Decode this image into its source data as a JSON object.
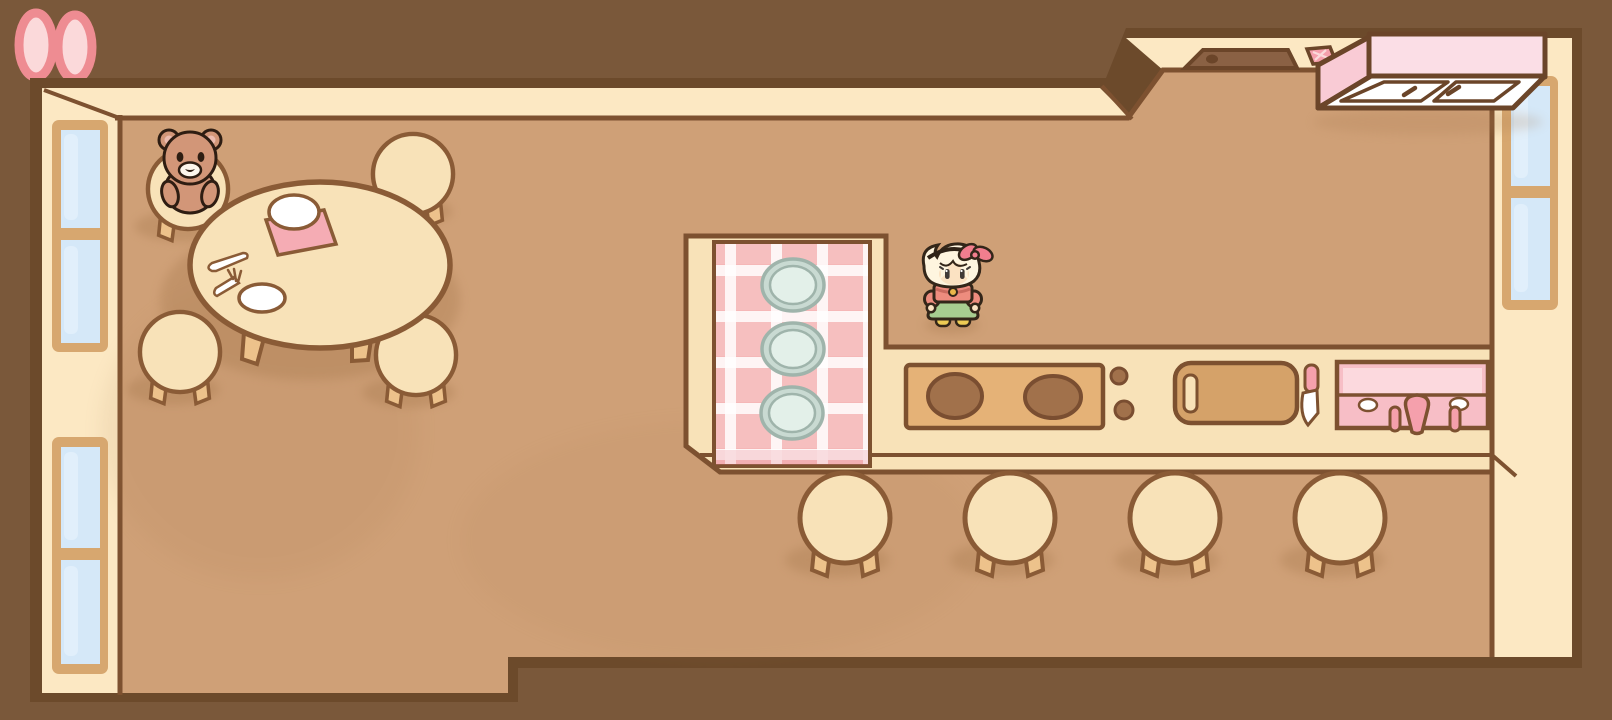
{
  "scene": {
    "title": "cozy-cafe-kitchen-room",
    "description": "Top-down cute cafe kitchen room with dining table, teddy bear, kitchen counter with stove and sink, bar stools, windows and a girl character standing by the counter"
  },
  "objects": {
    "decor": {
      "pink_ovals_top_left": 2
    },
    "dining_area": {
      "table": "round table",
      "stools": 4,
      "teddy_bear_seat": "top-left stool",
      "items_on_table": [
        "white plate",
        "pink napkin",
        "knife",
        "fork",
        "white plate"
      ]
    },
    "kitchen_counter": {
      "shape": "L",
      "tablecloth": "pink gingham",
      "plates_on_cloth": 3,
      "stove": {
        "burners": 2,
        "knobs": 2
      },
      "cutting_board": 1,
      "knife": 1,
      "sink": {
        "handles": 2,
        "faucet": 1,
        "soap_spots": 2
      }
    },
    "bar_stools": 4,
    "wall_counter": {
      "basin": 1,
      "drain": 1,
      "sponge": 1
    },
    "hanging_cabinet": {
      "doors": 2,
      "handles": 2
    },
    "windows": {
      "left_wall": 2,
      "right_wall": 1
    },
    "character": {
      "hair": "blonde with swoosh bang",
      "accessory": "pink bow headband",
      "top": "coral shirt with gold button",
      "skirt": "green",
      "shoes": "yellow"
    }
  },
  "palette": {
    "bg_outside": "#7A583A",
    "outline_dark": "#6C4A2B",
    "line_brown": "#7D5130",
    "furn_line": "#8A5B36",
    "wall_cream": "#FCE8C3",
    "floor_tan": "#CFA077",
    "shadow": "#A87A4F",
    "furniture_cream": "#F8E2B8",
    "furniture_leg": "#EDC28B",
    "cloth_pink": "#F5B7B7",
    "cloth_stripe": "#FFFFFF",
    "cloth_fold": "#E87F8C",
    "plate_rim": "#9FB4AB",
    "plate_outer": "#C9DAD2",
    "plate_inner": "#E3F0E9",
    "white": "#FFFFFF",
    "napkin_pink": "#F5ACB4",
    "stove_tan": "#E5B277",
    "burner_brown": "#A1714B",
    "burner_line": "#7A4E31",
    "board_tan": "#D5A269",
    "sink_pink": "#F7BEC6",
    "sink_light": "#FCD9DE",
    "sink_accent": "#F5A0AC",
    "cabinet_top": "#FBDEE6",
    "cabinet_side": "#F9CBD5",
    "cabinet_line": "#6B4529",
    "counter_sink_brown": "#8A6144",
    "window_frame": "#D7A76F",
    "window_glass": "#D5E8F8",
    "window_glass_light": "#EAF4FD",
    "oval_outer": "#EE8C92",
    "oval_inner": "#FBD9DA",
    "bear_body": "#D29678",
    "bear_ear": "#ECBBAE",
    "bear_muzzle": "#FDF6EC",
    "bear_outline": "#2E1D12",
    "girl_hair": "#FEF5DF",
    "girl_skin": "#FBE2C2",
    "girl_shirt": "#ED8C7E",
    "girl_shirt_line": "#C96A5E",
    "girl_skirt": "#A7CD90",
    "girl_shoe": "#EDCB54",
    "girl_bow": "#F27E8E",
    "girl_button": "#E9B64A",
    "girl_outline": "#332619",
    "girl_eye": "#403A36"
  }
}
